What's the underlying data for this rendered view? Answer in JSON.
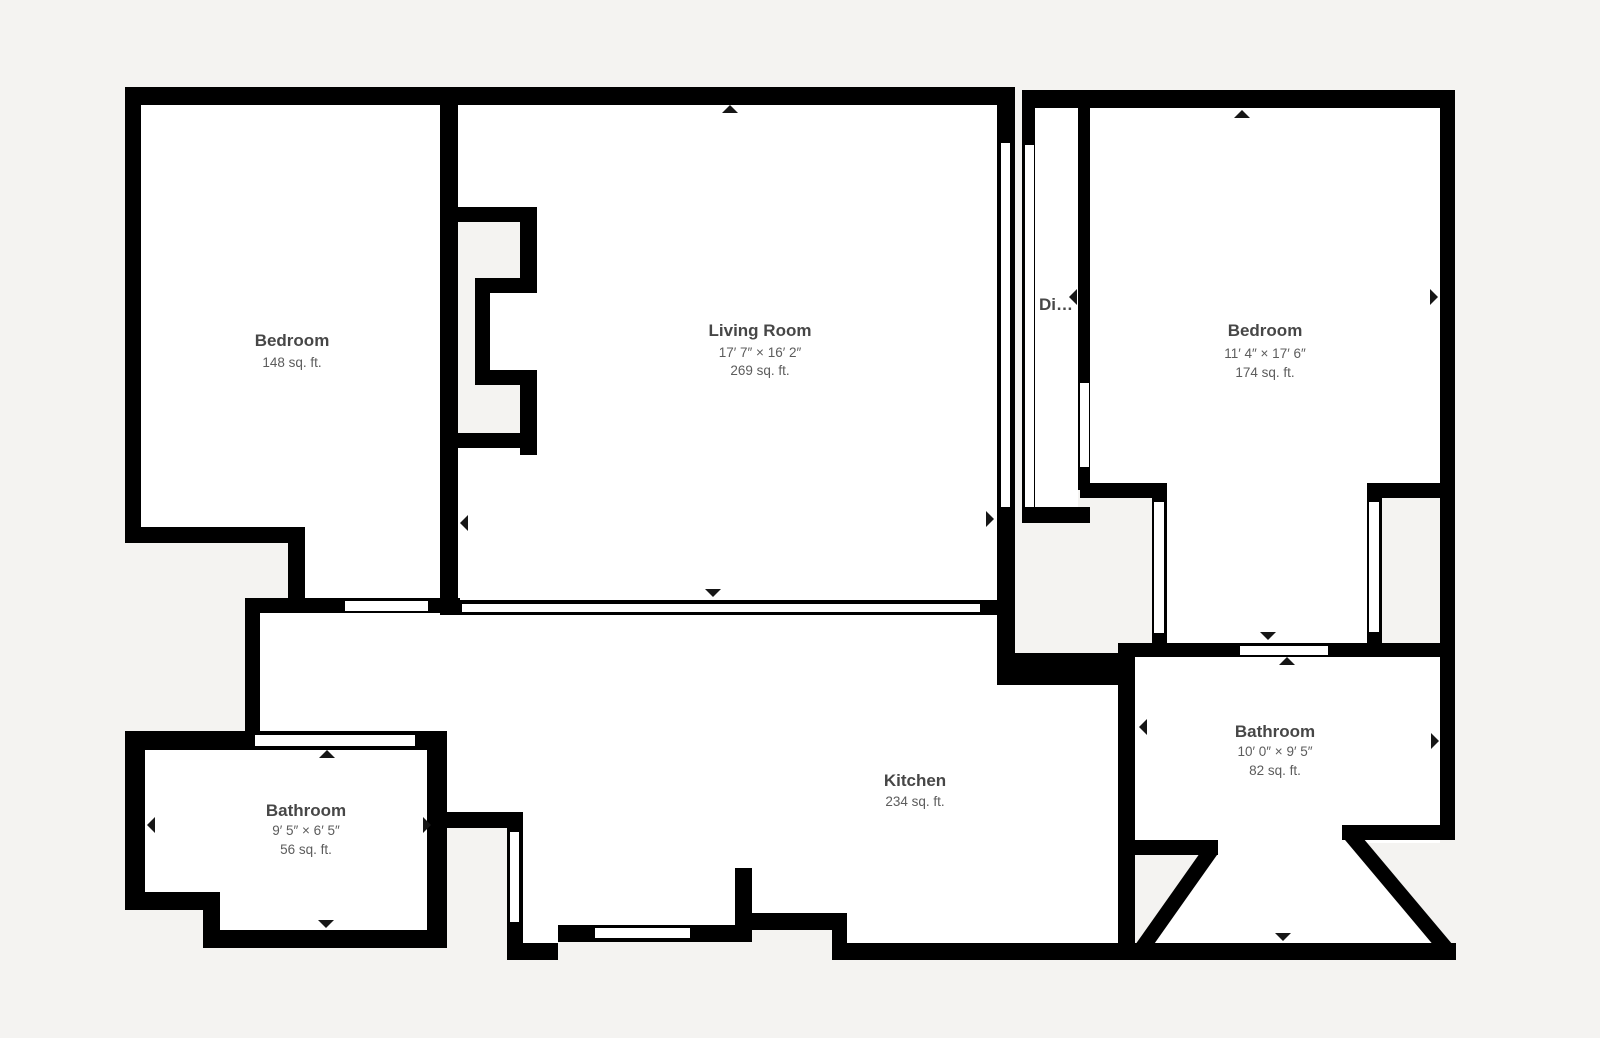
{
  "plan": {
    "background_color": "#f4f3f1",
    "wall_color": "#000000",
    "floor_color": "#ffffff",
    "text_color": "#474747",
    "rooms": [
      {
        "name": "Bedroom",
        "dimensions": "",
        "area": "148 sq. ft."
      },
      {
        "name": "Living Room",
        "dimensions": "17′ 7″ × 16′ 2″",
        "area": "269 sq. ft."
      },
      {
        "name": "Di…",
        "dimensions": "",
        "area": ""
      },
      {
        "name": "Bedroom",
        "dimensions": "11′ 4″ × 17′ 6″",
        "area": "174 sq. ft."
      },
      {
        "name": "Bathroom",
        "dimensions": "9′ 5″ × 6′ 5″",
        "area": "56 sq. ft."
      },
      {
        "name": "Kitchen",
        "dimensions": "",
        "area": "234 sq. ft."
      },
      {
        "name": "Bathroom",
        "dimensions": "10′ 0″ × 9′ 5″",
        "area": "82 sq. ft."
      }
    ]
  }
}
